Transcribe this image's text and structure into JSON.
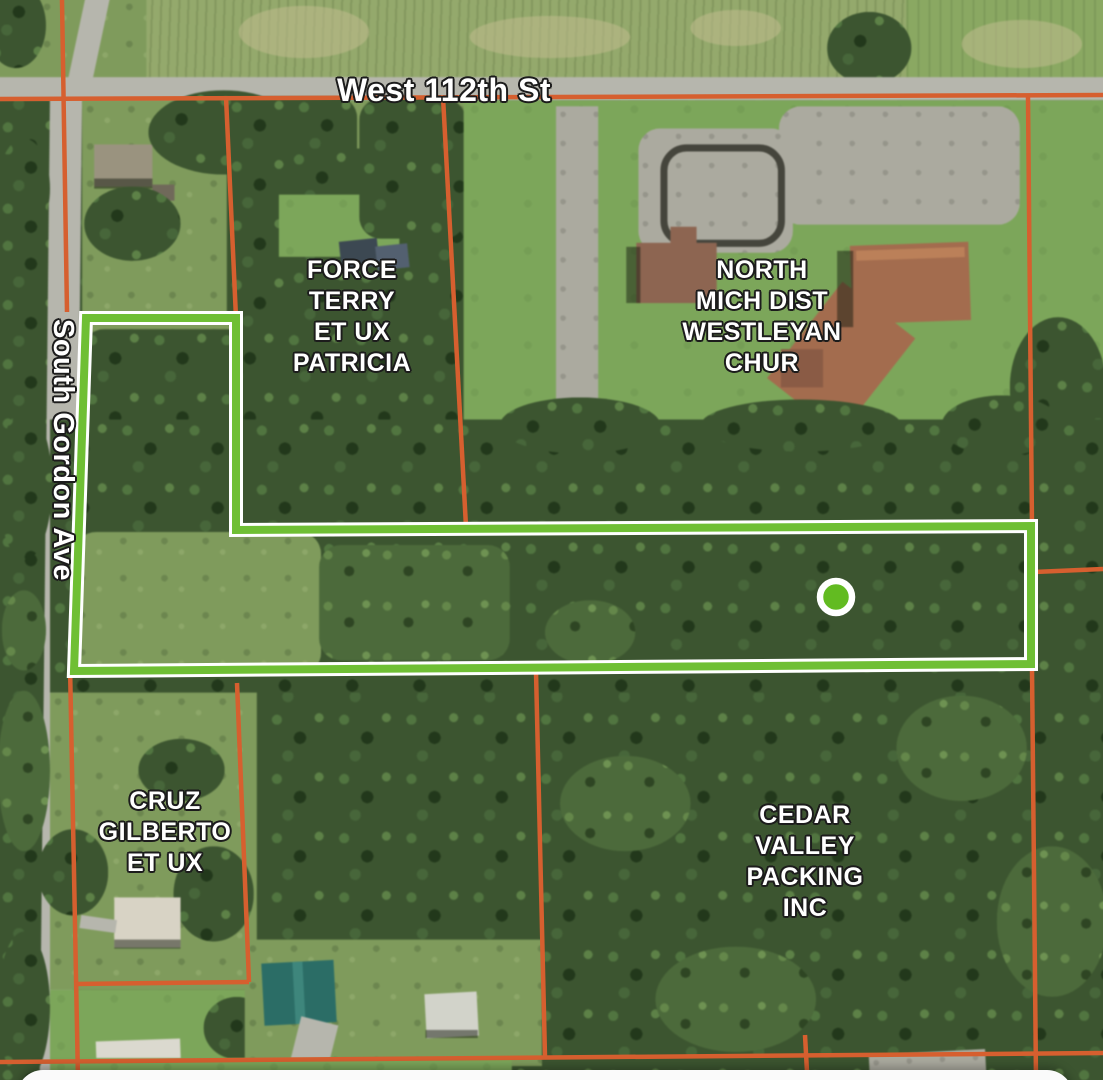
{
  "app": {
    "view": "parcel-map-satellite"
  },
  "map": {
    "streets": [
      {
        "name": "West 112th St",
        "orientation": "horizontal"
      },
      {
        "name": "South Gordon Ave",
        "orientation": "vertical"
      }
    ],
    "parcels": [
      {
        "owner": "FORCE\nTERRY\nET UX\nPATRICIA"
      },
      {
        "owner": "NORTH\nMICH DIST\nWESTLEYAN\nCHUR"
      },
      {
        "owner": "CRUZ\nGILBERTO\nET UX"
      },
      {
        "owner": "CEDAR\nVALLEY\nPACKING\nINC"
      }
    ],
    "selected_parcel": {
      "marker": "green-dot",
      "outline": "green-with-white-casing"
    }
  },
  "colors": {
    "parcel_line": "#d65f2f",
    "highlight_outline": "#6fbf34",
    "highlight_casing": "#ffffff",
    "marker_fill": "#62bb21",
    "label_text": "#ffffff",
    "bottom_sheet": "#fafafa"
  }
}
